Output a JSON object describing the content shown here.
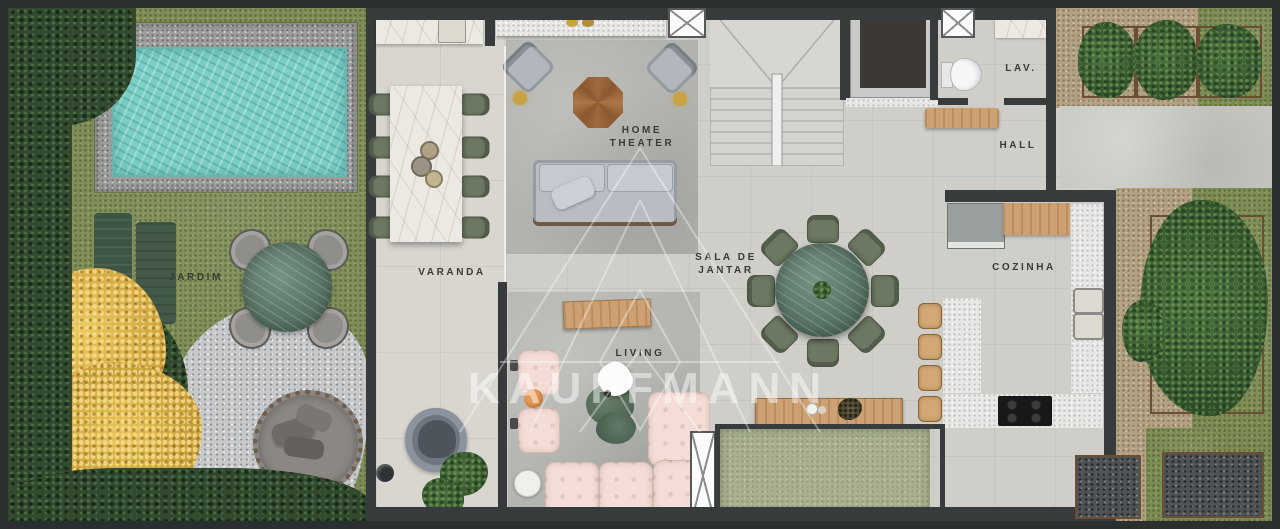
{
  "watermark": {
    "brand": "KAUFFMANN"
  },
  "rooms": {
    "jardim": {
      "label": "JARDIM"
    },
    "varanda": {
      "label": "VARANDA"
    },
    "home_theater": {
      "line1": "HOME",
      "line2": "THEATER"
    },
    "living": {
      "label": "LIVING"
    },
    "sala_de_jantar": {
      "line1": "SALA DE",
      "line2": "JANTAR"
    },
    "lav": {
      "label": "LAV."
    },
    "hall": {
      "label": "HALL"
    },
    "cozinha": {
      "label": "COZINHA"
    }
  },
  "palette": {
    "wall": "#383b3b",
    "pool_water": "#7ccfc6",
    "grass": "#7d8b54",
    "hedge": "#31492f",
    "marble_white": "#ece9e3",
    "marble_green": "#5e7a6b",
    "wood": "#cda173",
    "sofa_gray": "#b9bdc3",
    "sofa_pink": "#f3ddd6",
    "chair_olive": "#6d7863",
    "courtyard_green": "#a9b091",
    "accent_gold": "#c8a243"
  }
}
